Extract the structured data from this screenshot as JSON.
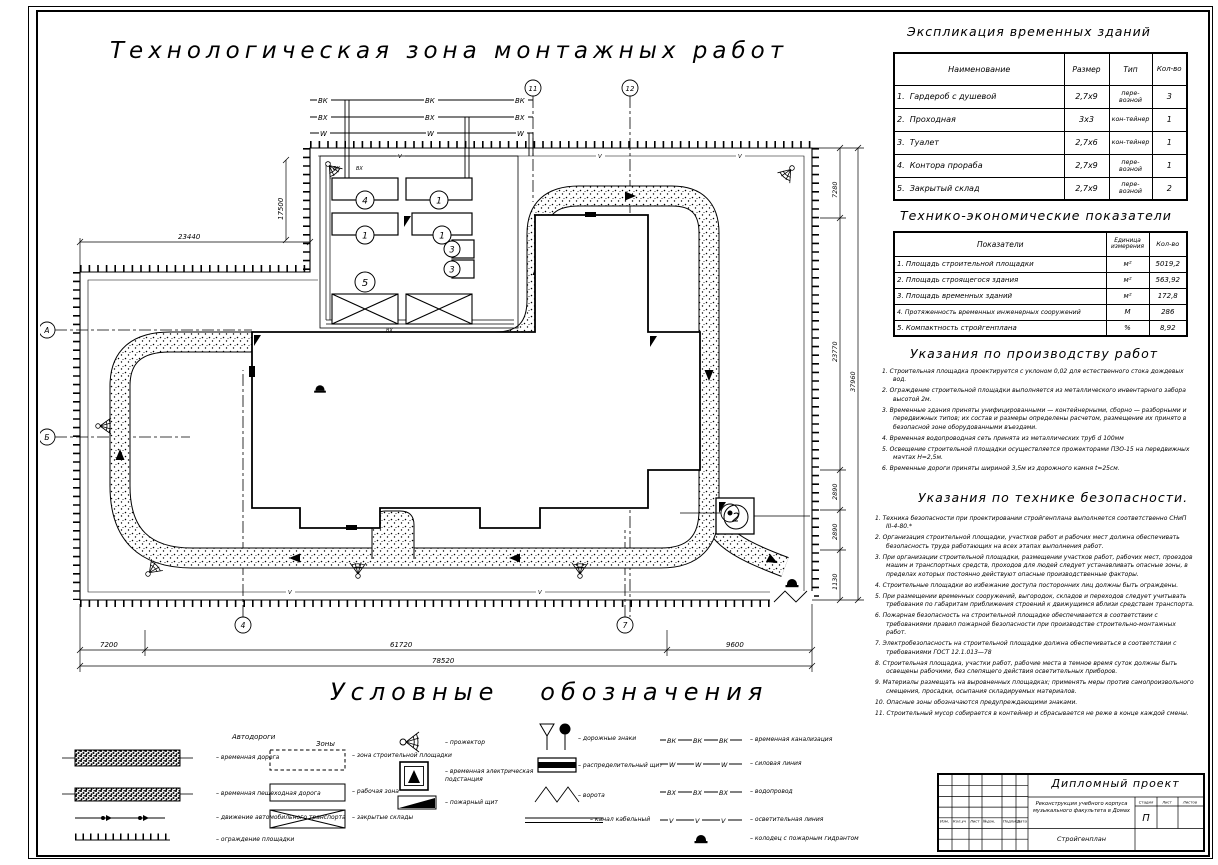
{
  "colors": {
    "ink": "#000000",
    "paper": "#ffffff"
  },
  "sheet": {
    "title": "Технологическая зона монтажных работ",
    "legend_title": "Условные   обозначения"
  },
  "plan": {
    "utilities": {
      "vk": "ВК",
      "vh": "ВХ",
      "w": "W",
      "v": "V"
    },
    "axes": {
      "top_left": "11",
      "top_right": "12",
      "bottom_left": "4",
      "bottom_right": "7",
      "left_upper": "А",
      "left_lower": "Б"
    },
    "marks": {
      "office": "4",
      "wardrobe1": "1",
      "wardrobe2": "1",
      "wardrobe3": "1",
      "toilet1": "3",
      "toilet2": "3",
      "storage": "5",
      "checkpoint": "2"
    },
    "dims": {
      "bottom_seg1": "7200",
      "bottom_seg2": "61720",
      "bottom_seg3": "9600",
      "bottom_total": "78520",
      "right_seg1": "7280",
      "right_seg2": "23770",
      "right_seg3": "2890",
      "right_seg4": "2890",
      "right_seg5": "1130",
      "right_total": "37960",
      "top_left": "23440",
      "yard_left": "17500"
    }
  },
  "explication": {
    "title": "Экспликация временных зданий",
    "headers": {
      "name": "Наименование",
      "size": "Размер",
      "type": "Тип",
      "qty": "Кол-во"
    },
    "rows": [
      {
        "n": "1.",
        "name": "Гардероб с душевой",
        "size": "2,7х9",
        "type": "пере-возной",
        "qty": "3"
      },
      {
        "n": "2.",
        "name": "Проходная",
        "size": "3х3",
        "type": "кон-тейнер",
        "qty": "1"
      },
      {
        "n": "3.",
        "name": "Туалет",
        "size": "2,7х6",
        "type": "кон-тейнер",
        "qty": "1"
      },
      {
        "n": "4.",
        "name": "Контора прораба",
        "size": "2,7х9",
        "type": "пере-возной",
        "qty": "1"
      },
      {
        "n": "5.",
        "name": "Закрытый склад",
        "size": "2,7х9",
        "type": "пере-возной",
        "qty": "2"
      }
    ]
  },
  "tep": {
    "title": "Технико-экономические показатели",
    "headers": {
      "name": "Показатели",
      "unit": "Единица измерения",
      "qty": "Кол-во"
    },
    "rows": [
      {
        "n": "1.",
        "name": "Площадь строительной площадки",
        "unit": "м²",
        "qty": "5019,2"
      },
      {
        "n": "2.",
        "name": "Площадь строящегося здания",
        "unit": "м²",
        "qty": "563,92"
      },
      {
        "n": "3.",
        "name": "Площадь временных зданий",
        "unit": "м²",
        "qty": "172,8"
      },
      {
        "n": "4.",
        "name": "Протяженность временных инженерных сооружений",
        "unit": "М",
        "qty": "286"
      },
      {
        "n": "5.",
        "name": "Компактность стройгенплана",
        "unit": "%",
        "qty": "8,92"
      }
    ]
  },
  "work_instructions": {
    "title": "Указания по производству работ",
    "items": [
      "1. Строительная площадка проектируется с уклоном 0,02 для естественного стока дождевых вод.",
      "2. Ограждение строительной площадки выполняется из металлического инвентарного забора высотой 2м.",
      "3. Временные здания приняты унифицированными — контейнерными, сборно — разборными и передвижных типов; их состав и размеры определены расчетом, размещение их принято в безопасной зоне оборудованными въездами.",
      "4. Временная водопроводная сеть принята из металлических труб d 100мм",
      "5. Освещение строительной площадки осуществляется прожекторами ПЗО-15 на передвижных мачтах Н=2,5м.",
      "6. Временные дороги приняты шириной 3,5м из дорожного камня t=25см."
    ]
  },
  "safety_instructions": {
    "title": "Указания по технике безопасности.",
    "items": [
      "1. Техника безопасности при проектировании стройгенплана выполняется соответственно СНиП III-4-80.*",
      "2. Организация строительной площадки, участков работ и рабочих мест должна обеспечивать безопасность труда работающих на всех этапах выполнения работ.",
      "3. При организации строительной площадки, размещении участков работ, рабочих мест, проездов машин и транспортных средств, проходов для людей следует устанавливать опасные зоны, в пределах которых постоянно действуют опасные производственные факторы.",
      "4. Строительные площадки во избежание доступа посторонних лиц должны быть ограждены.",
      "5. При размещении временных сооружений, выгородок, складов и переходов следует учитывать требования по габаритам приближения строений к движущимся вблизи средствам транспорта.",
      "6. Пожарная безопасность на строительной площадке обеспечивается в соответствии с требованиями правил пожарной безопасности при производстве строительно-монтажных работ.",
      "7. Электробезопасность на строительной площадке должна обеспечиваться в соответствии с требованиями ГОСТ 12.1.013—78",
      "8. Строительная площадка, участки работ, рабочие места в темное время суток должны быть освещены рабочими, без слепящего действия осветительных приборов.",
      "9. Материалы размещать на выровненных площадках; применять меры против самопроизвольного смещения, просадки, осыпания складируемых материалов.",
      "10. Опасные зоны обозначаются предупреждающими знаками.",
      "11. Строительный мусор собирается в контейнер и сбрасывается не реже в конце каждой смены."
    ]
  },
  "legend": {
    "roads_header": "Автодороги",
    "zones_header": "Зоны",
    "temp_road": "временная дорога",
    "temp_ped_road": "временная пешеходная дорога",
    "traffic": "движение автомобильного транспорта",
    "fence": "ограждение площадки",
    "site_zone": "зона строительной площадки",
    "work_zone": "рабочая зона",
    "closed_storage": "закрытые склады",
    "floodlight": "прожектор",
    "substation": "временная электрическая подстанция",
    "fire_shield": "пожарный щит",
    "road_signs": "дорожные знаки",
    "distribution_board": "распределительный щит",
    "gates": "ворота",
    "cable_channel": "канал кабельный",
    "temp_sewer": "временная канализация",
    "power_line": "силовая линия",
    "water_line": "водопровод",
    "light_line": "осветительная линия",
    "hydrant": "колодец с пожарным гидрантом",
    "tags": {
      "vk": "ВК",
      "w": "W",
      "vh": "ВХ",
      "v": "V"
    }
  },
  "titleblock": {
    "project": "Дипломный проект",
    "rev_row": [
      "Изм.",
      "Кол.уч",
      "Лист",
      "№док.",
      "Подпись",
      "Дата"
    ],
    "object": "Реконструкция учебного корпуса музыкального факультета в Домах",
    "stage_h": "Стадия",
    "sheet_h": "Лист",
    "sheets_h": "Листов",
    "stage": "П",
    "content": "Стройгенплан"
  }
}
